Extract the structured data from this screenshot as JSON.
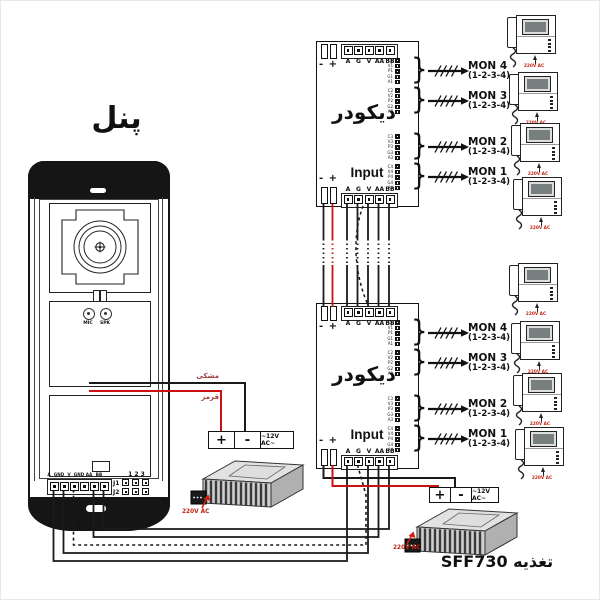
{
  "panel": {
    "title": "پنل",
    "mic": "MIC",
    "spk": "SPK",
    "wire_labels": {
      "black": "مشکی",
      "red": "قرمز"
    },
    "terminals": [
      "A",
      "GND",
      "V",
      "GND",
      "AA",
      "BB"
    ],
    "jumper": {
      "header": "1 2 3",
      "rows": [
        "J1",
        "J2"
      ]
    }
  },
  "decoders": [
    {
      "title": "دیکودر",
      "input_label": "Input",
      "power_label": "- +",
      "top_terminals": [
        "A",
        "G",
        "V",
        "AA",
        "BB"
      ],
      "input_terminals": [
        "A",
        "G",
        "V",
        "AA",
        "BB"
      ],
      "strips": [
        [
          "C1",
          "V1",
          "P1",
          "G1",
          "A1"
        ],
        [
          "C2",
          "V2",
          "P2",
          "G2",
          "A2"
        ],
        [
          "C3",
          "V3",
          "P3",
          "G3",
          "A3"
        ],
        [
          "C4",
          "V4",
          "P4",
          "G4",
          "A4"
        ]
      ],
      "mons": [
        {
          "name": "MON 4",
          "wires": "(1-2-3-4)"
        },
        {
          "name": "MON 3",
          "wires": "(1-2-3-4)"
        },
        {
          "name": "MON 2",
          "wires": "(1-2-3-4)"
        },
        {
          "name": "MON 1",
          "wires": "(1-2-3-4)"
        }
      ]
    },
    {
      "title": "دیکودر",
      "input_label": "Input",
      "power_label": "- +",
      "top_terminals": [
        "A",
        "G",
        "V",
        "AA",
        "BB"
      ],
      "input_terminals": [
        "A",
        "G",
        "V",
        "AA",
        "BB"
      ],
      "strips": [
        [
          "C1",
          "V1",
          "P1",
          "G1",
          "A1"
        ],
        [
          "C2",
          "V2",
          "P2",
          "G2",
          "A2"
        ],
        [
          "C3",
          "V3",
          "P3",
          "G3",
          "A3"
        ],
        [
          "C4",
          "V4",
          "P4",
          "G4",
          "A4"
        ]
      ],
      "mons": [
        {
          "name": "MON 4",
          "wires": "(1-2-3-4)"
        },
        {
          "name": "MON 3",
          "wires": "(1-2-3-4)"
        },
        {
          "name": "MON 2",
          "wires": "(1-2-3-4)"
        },
        {
          "name": "MON 1",
          "wires": "(1-2-3-4)"
        }
      ]
    }
  ],
  "power_supplies": [
    {
      "plus": "+",
      "minus": "-",
      "voltage": "~12V AC~",
      "mains": "220V AC"
    },
    {
      "plus": "+",
      "minus": "-",
      "voltage": "~12V AC~",
      "mains": "220V AC",
      "name": "تغذیه SFF730"
    }
  ],
  "monitor": {
    "mains": "220V AC"
  },
  "colors": {
    "wire_red": "#cc1111",
    "wire_black": "#1a1a1a",
    "mains_red": "#cc2211"
  }
}
